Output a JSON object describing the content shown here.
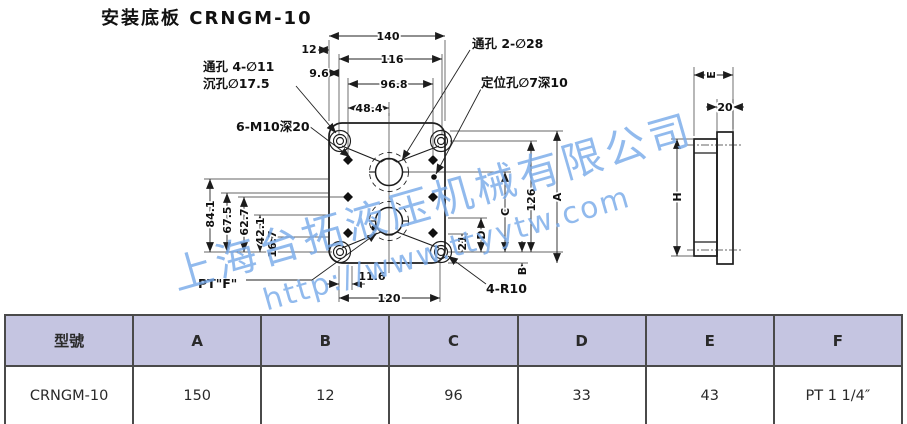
{
  "title": "安装底板 CRNGM-10",
  "watermark": {
    "line1": "上海台拓液压机械有限公司",
    "line2": "http://www.ttyytw.com",
    "color": "#7aabea"
  },
  "plan": {
    "callouts": {
      "through4": "通孔 4-∅11",
      "cbore": "沉孔∅17.5",
      "tap": "6-M10深20",
      "through2": "通孔 2-∅28",
      "pin": "定位孔∅7深10",
      "port": "PT\"F\"",
      "corner_r": "4-R10"
    },
    "dims": {
      "top": {
        "d140": "140",
        "d12": "12",
        "d116": "116",
        "d9_6": "9.6",
        "d96_8": "96.8",
        "d48_4": "48.4"
      },
      "left": {
        "d84_1": "84.1",
        "d67_5": "67.5",
        "d62_7": "62.7",
        "d42_1": "42.1",
        "d16_7": "16.7"
      },
      "bottom": {
        "d11_6": "11.6",
        "d120": "120"
      },
      "right": {
        "d21": "21",
        "dD": "D",
        "dC": "C",
        "d126": "126",
        "dA": "A",
        "dB": "B"
      }
    }
  },
  "side": {
    "dims": {
      "dE": "E",
      "d20": "20",
      "dH": "H"
    }
  },
  "table": {
    "headers": [
      "型號",
      "A",
      "B",
      "C",
      "D",
      "E",
      "F"
    ],
    "row": [
      "CRNGM-10",
      "150",
      "12",
      "96",
      "33",
      "43",
      "PT 1 1/4″"
    ],
    "header_bg": "#c5c5e1",
    "border_color": "#4a4a4a"
  }
}
